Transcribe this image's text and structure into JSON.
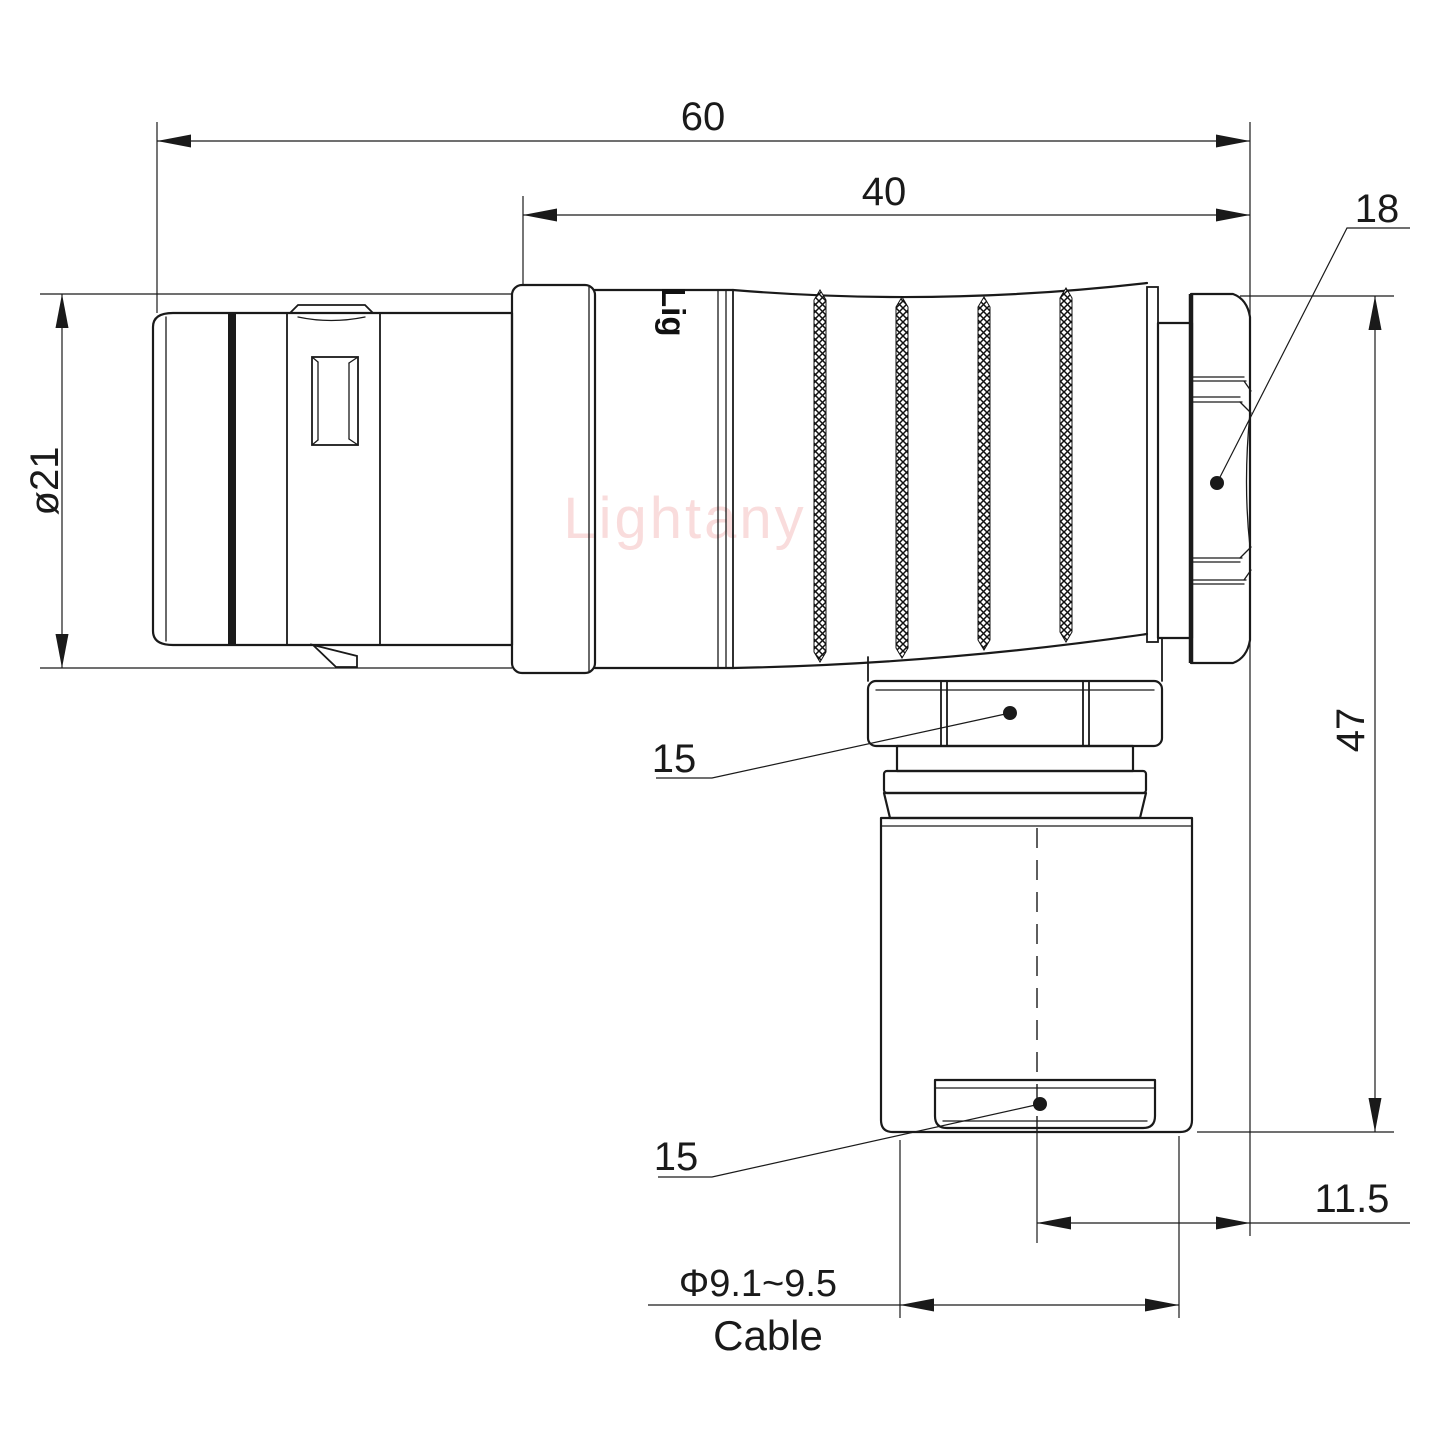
{
  "drawing": {
    "watermark": "Lightany",
    "body_print": "Lig",
    "dimensions": {
      "overall_length": "60",
      "rear_length": "40",
      "nut_size": "18",
      "body_diameter": "ø21",
      "height": "47",
      "coupling_nut": "15",
      "cable_clamp": "15",
      "cable_offset": "11.5",
      "cable_range": "Φ9.1~9.5",
      "cable_label": "Cable"
    },
    "colors": {
      "line": "#1a1a1a",
      "watermark": "#f8d7d7",
      "background": "#ffffff"
    }
  }
}
